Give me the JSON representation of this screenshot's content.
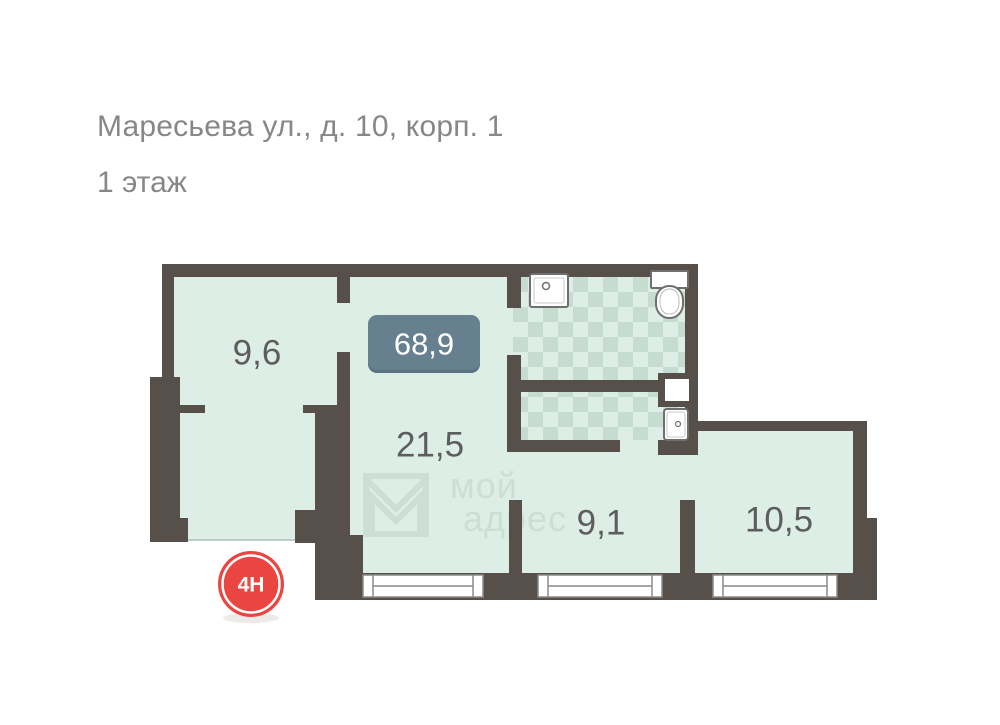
{
  "header": {
    "address": "Маресьева ул., д. 10, корп. 1",
    "floor": "1 этаж"
  },
  "plan": {
    "total_area": "68,9",
    "unit_number": "4Н",
    "rooms": [
      {
        "area": "9,6"
      },
      {
        "area": "21,5"
      },
      {
        "area": "9,1"
      },
      {
        "area": "10,5"
      }
    ],
    "watermark": {
      "word1": "мой",
      "word2": "адрес"
    },
    "colors": {
      "wall": "#57504A",
      "floor": "#DDEEE6",
      "checker": "#C6DCD1",
      "total_area_badge": "#67808F",
      "unit_badge": "#EA4540",
      "room_label_text": "#5D5D5D",
      "header_text": "#878787",
      "watermark": "#CBDFD5",
      "fixture_outline": "#6F6F6F"
    }
  }
}
